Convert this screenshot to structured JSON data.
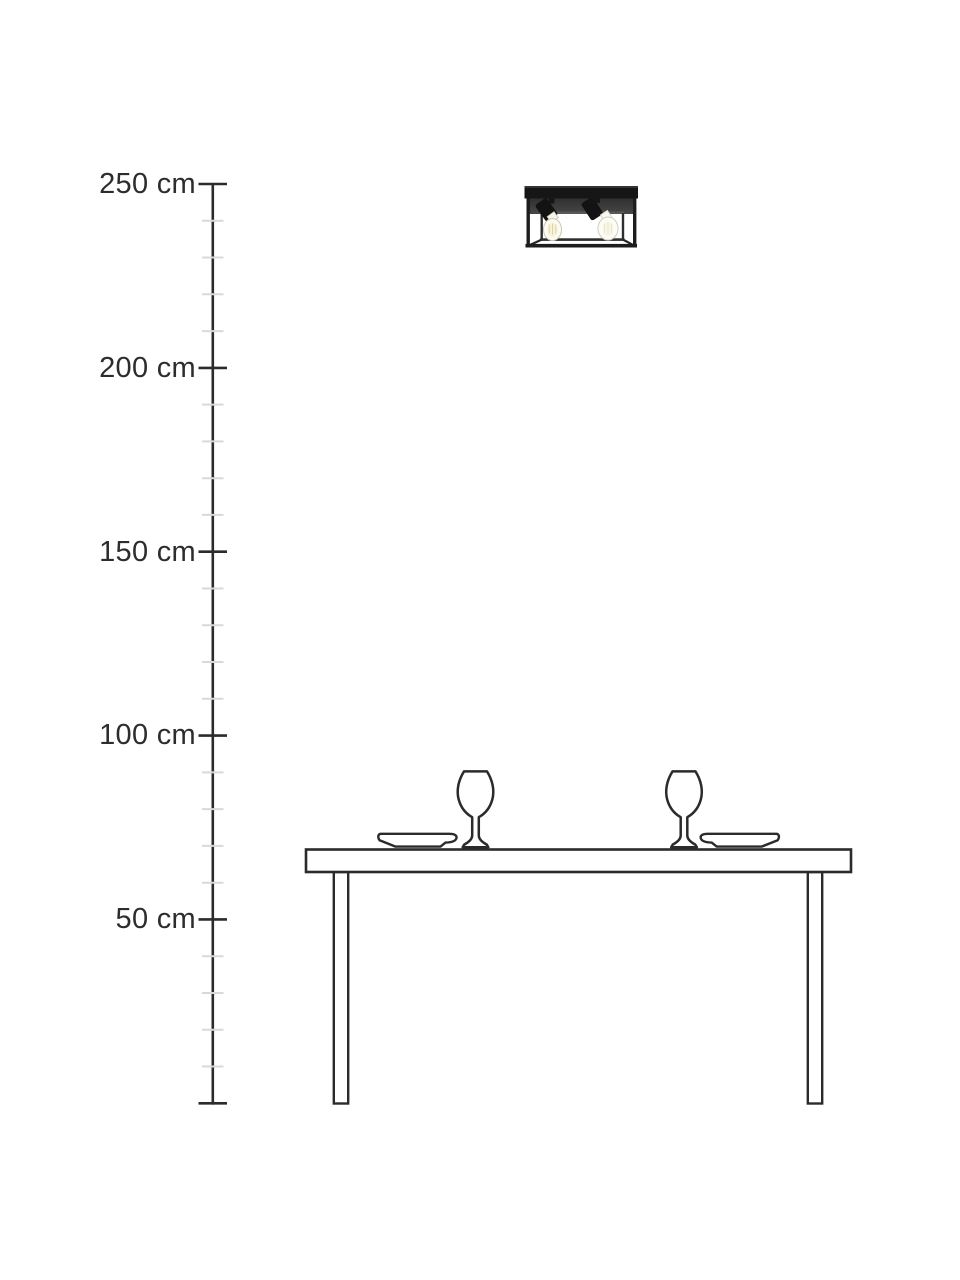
{
  "page": {
    "background_color": "#ffffff",
    "description": "Product height diagram: black two-spot cage ceiling lamp mounted at ceiling height above a dining table with two wine glasses and two plates"
  },
  "ruler": {
    "unit": "cm",
    "min_value_cm": 0,
    "max_value_cm": 250,
    "minor_tick_step_cm": 10,
    "major_tick_step_cm": 50,
    "labeled_ticks": [
      {
        "value_cm": 250,
        "label": "250 cm"
      },
      {
        "value_cm": 200,
        "label": "200 cm"
      },
      {
        "value_cm": 150,
        "label": "150 cm"
      },
      {
        "value_cm": 100,
        "label": "100 cm"
      },
      {
        "value_cm": 50,
        "label": "50 cm"
      }
    ],
    "colors": {
      "axis": "#2b2b2b",
      "major_tick": "#2b2b2b",
      "minor_tick": "#d9d9d9",
      "label_text": "#2d2d2d"
    }
  },
  "illustration": {
    "lamp": {
      "name": "two-spot-cage-ceiling-lamp",
      "mounted_at_cm": 250,
      "frame_color": "#1a1a1a",
      "bulb_color": "#fcfbf3"
    },
    "furniture": {
      "items": [
        "dining-table",
        "wine-glass-left",
        "wine-glass-right",
        "plate-left",
        "plate-right"
      ],
      "outline_color": "#2b2b2b",
      "fill_color": "#ffffff"
    }
  }
}
